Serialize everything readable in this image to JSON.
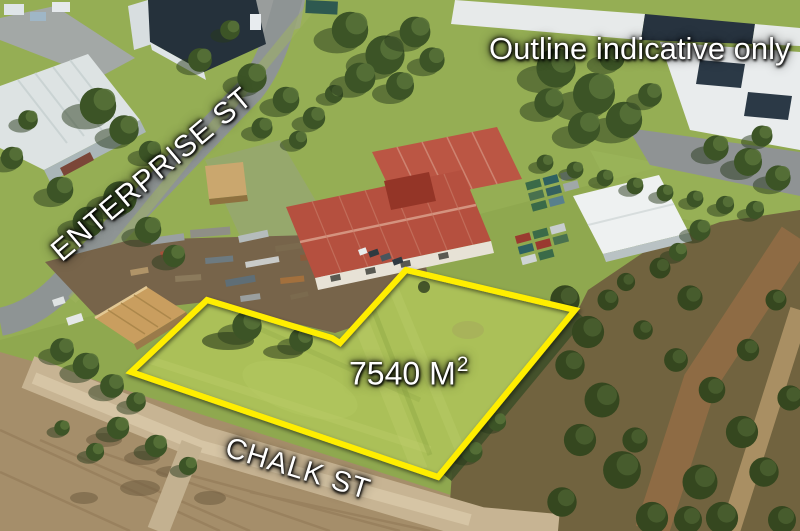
{
  "photo": {
    "disclaimer": "Outline indicative only",
    "street_enterprise": "ENTERPRISE ST",
    "street_chalk": "CHALK ST",
    "area": {
      "text": "7540 M",
      "superscript": "2"
    },
    "outline_color": "#ffee00"
  }
}
